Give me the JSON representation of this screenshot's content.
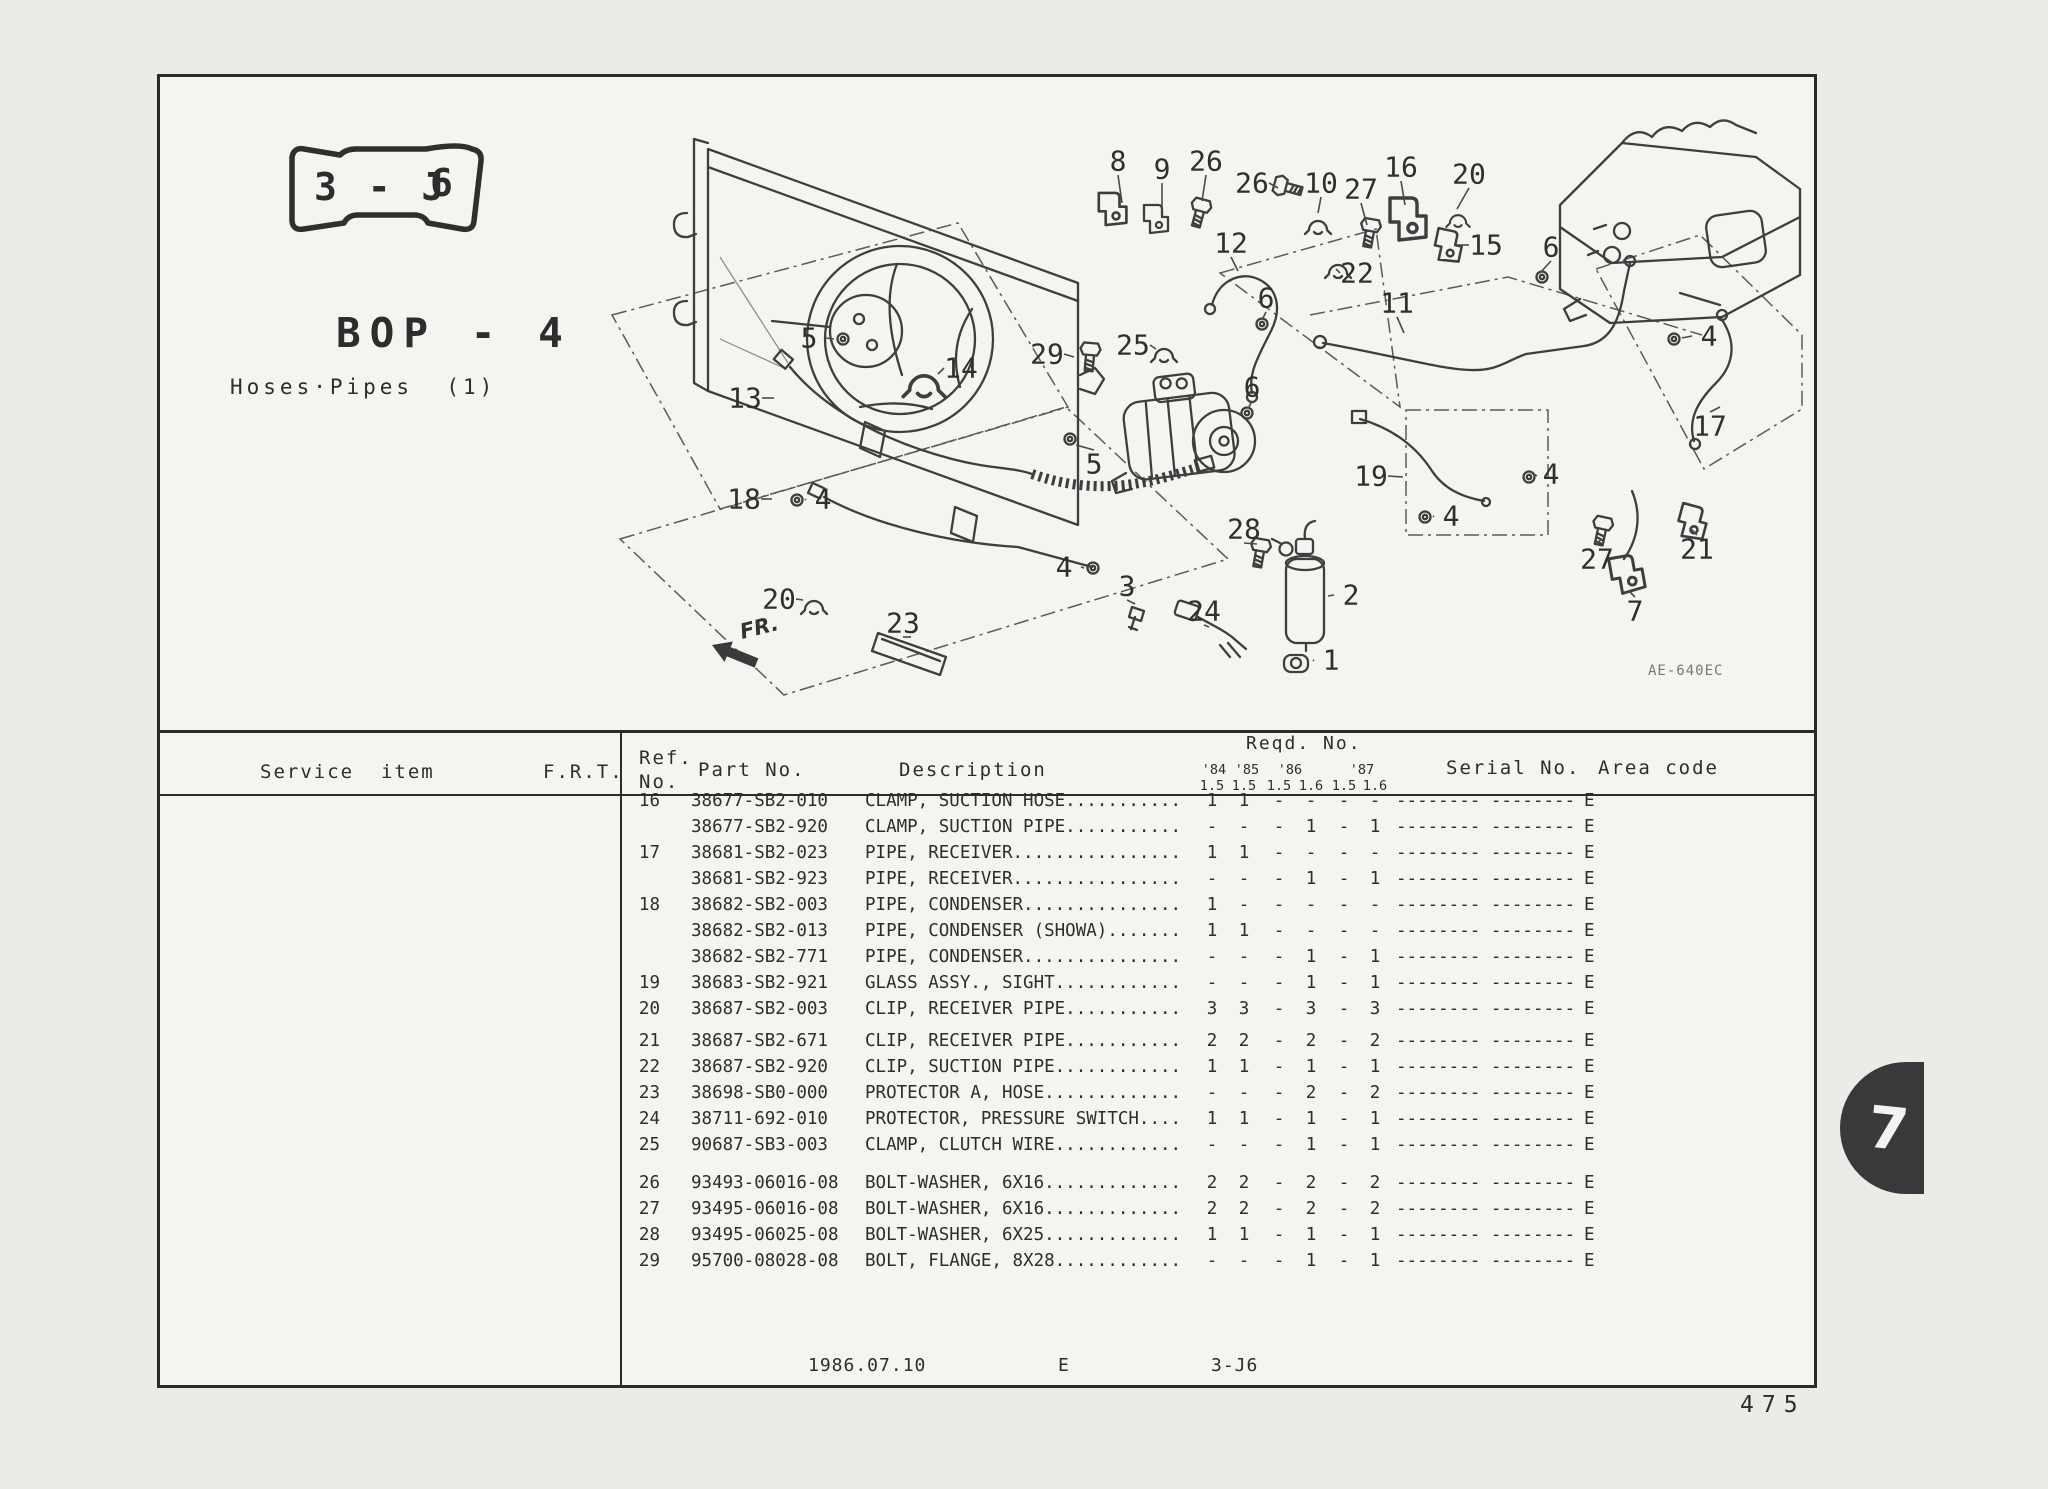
{
  "page": {
    "number": "475",
    "tab": "7"
  },
  "badge": {
    "left": "3 - J",
    "right": "6"
  },
  "header": {
    "title": "BOP - 4",
    "subtitle": "Hoses·Pipes  (1)"
  },
  "diagram": {
    "fr_label": "FR.",
    "code": "AE-640EC",
    "callouts": [
      {
        "t": "8",
        "x": 958,
        "y": 84,
        "lx": 962,
        "ly": 126
      },
      {
        "t": "9",
        "x": 1002,
        "y": 92,
        "lx": 1002,
        "ly": 134
      },
      {
        "t": "26",
        "x": 1046,
        "y": 84,
        "lx": 1042,
        "ly": 124
      },
      {
        "t": "26",
        "x": 1092,
        "y": 106,
        "lx": 1118,
        "ly": 111
      },
      {
        "t": "10",
        "x": 1161,
        "y": 106,
        "lx": 1158,
        "ly": 136
      },
      {
        "t": "27",
        "x": 1201,
        "y": 112,
        "lx": 1207,
        "ly": 148
      },
      {
        "t": "16",
        "x": 1241,
        "y": 90,
        "lx": 1245,
        "ly": 128
      },
      {
        "t": "20",
        "x": 1309,
        "y": 97,
        "lx": 1297,
        "ly": 132
      },
      {
        "t": "15",
        "x": 1326,
        "y": 168,
        "lx": 1298,
        "ly": 168
      },
      {
        "t": "12",
        "x": 1071,
        "y": 166,
        "lx": 1078,
        "ly": 194
      },
      {
        "t": "22",
        "x": 1197,
        "y": 196,
        "lx": 1176,
        "ly": 192
      },
      {
        "t": "6",
        "x": 1391,
        "y": 170,
        "lx": 1380,
        "ly": 196
      },
      {
        "t": "11",
        "x": 1237,
        "y": 226,
        "lx": 1244,
        "ly": 256
      },
      {
        "t": "29",
        "x": 887,
        "y": 277,
        "lx": 914,
        "ly": 280
      },
      {
        "t": "25",
        "x": 973,
        "y": 268,
        "lx": 996,
        "ly": 272
      },
      {
        "t": "6",
        "x": 1106,
        "y": 221,
        "lx": 1102,
        "ly": 243
      },
      {
        "t": "6",
        "x": 1092,
        "y": 310,
        "lx": 1088,
        "ly": 332
      },
      {
        "t": "5",
        "x": 649,
        "y": 261,
        "lx": 674,
        "ly": 262
      },
      {
        "t": "13",
        "x": 585,
        "y": 321,
        "lx": 614,
        "ly": 321
      },
      {
        "t": "14",
        "x": 801,
        "y": 291,
        "lx": 778,
        "ly": 297
      },
      {
        "t": "4",
        "x": 1549,
        "y": 259,
        "lx": 1522,
        "ly": 261
      },
      {
        "t": "17",
        "x": 1550,
        "y": 349,
        "lx": 1560,
        "ly": 330
      },
      {
        "t": "5",
        "x": 934,
        "y": 387,
        "lx": 916,
        "ly": 368
      },
      {
        "t": "19",
        "x": 1211,
        "y": 399,
        "lx": 1243,
        "ly": 400
      },
      {
        "t": "4",
        "x": 1391,
        "y": 397,
        "lx": 1377,
        "ly": 399
      },
      {
        "t": "18",
        "x": 584,
        "y": 422,
        "lx": 612,
        "ly": 422
      },
      {
        "t": "4",
        "x": 663,
        "y": 422,
        "lx": 645,
        "ly": 423
      },
      {
        "t": "4",
        "x": 1291,
        "y": 439,
        "lx": 1273,
        "ly": 440
      },
      {
        "t": "21",
        "x": 1537,
        "y": 472,
        "lx": 1531,
        "ly": 452
      },
      {
        "t": "28",
        "x": 1084,
        "y": 452,
        "lx": 1097,
        "ly": 467
      },
      {
        "t": "27",
        "x": 1437,
        "y": 482,
        "lx": 1441,
        "ly": 462
      },
      {
        "t": "4",
        "x": 904,
        "y": 490,
        "lx": 924,
        "ly": 491
      },
      {
        "t": "3",
        "x": 967,
        "y": 509,
        "lx": 975,
        "ly": 527
      },
      {
        "t": "2",
        "x": 1191,
        "y": 518,
        "lx": 1168,
        "ly": 519
      },
      {
        "t": "7",
        "x": 1475,
        "y": 534,
        "lx": 1469,
        "ly": 514
      },
      {
        "t": "20",
        "x": 619,
        "y": 522,
        "lx": 643,
        "ly": 523
      },
      {
        "t": "23",
        "x": 743,
        "y": 546,
        "lx": 751,
        "ly": 560
      },
      {
        "t": "24",
        "x": 1044,
        "y": 534,
        "lx": 1049,
        "ly": 550
      },
      {
        "t": "1",
        "x": 1171,
        "y": 583,
        "lx": 1153,
        "ly": 584
      }
    ]
  },
  "table": {
    "col_service": "Service  item",
    "col_frt": "F.R.T.",
    "col_ref": "Ref.",
    "col_ref2": "No.",
    "col_part": "Part No.",
    "col_desc": "Description",
    "col_reqd": "Reqd. No.",
    "years": [
      "'84",
      "'85",
      "'86",
      "'87"
    ],
    "sizes": [
      "1.5",
      "1.5",
      "1.5",
      "1.6",
      "1.5",
      "1.6"
    ],
    "col_serial": "Serial No.",
    "col_area": "Area code",
    "groups": [
      [
        {
          "ref": "16",
          "part": "38677-SB2-010",
          "desc": "CLAMP, SUCTION HOSE...........",
          "qty": [
            "1",
            "1",
            "-",
            "-",
            "-",
            "-"
          ],
          "serial": "-------- --------",
          "area": "E"
        },
        {
          "ref": "",
          "part": "38677-SB2-920",
          "desc": "CLAMP, SUCTION PIPE...........",
          "qty": [
            "-",
            "-",
            "-",
            "1",
            "-",
            "1"
          ],
          "serial": "-------- --------",
          "area": "E"
        },
        {
          "ref": "17",
          "part": "38681-SB2-023",
          "desc": "PIPE, RECEIVER................",
          "qty": [
            "1",
            "1",
            "-",
            "-",
            "-",
            "-"
          ],
          "serial": "-------- --------",
          "area": "E"
        },
        {
          "ref": "",
          "part": "38681-SB2-923",
          "desc": "PIPE, RECEIVER................",
          "qty": [
            "-",
            "-",
            "-",
            "1",
            "-",
            "1"
          ],
          "serial": "-------- --------",
          "area": "E"
        },
        {
          "ref": "18",
          "part": "38682-SB2-003",
          "desc": "PIPE, CONDENSER...............",
          "qty": [
            "1",
            "-",
            "-",
            "-",
            "-",
            "-"
          ],
          "serial": "-------- --------",
          "area": "E"
        },
        {
          "ref": "",
          "part": "38682-SB2-013",
          "desc": "PIPE, CONDENSER (SHOWA).......",
          "qty": [
            "1",
            "1",
            "-",
            "-",
            "-",
            "-"
          ],
          "serial": "-------- --------",
          "area": "E"
        },
        {
          "ref": "",
          "part": "38682-SB2-771",
          "desc": "PIPE, CONDENSER...............",
          "qty": [
            "-",
            "-",
            "-",
            "1",
            "-",
            "1"
          ],
          "serial": "-------- --------",
          "area": "E"
        },
        {
          "ref": "19",
          "part": "38683-SB2-921",
          "desc": "GLASS ASSY., SIGHT............",
          "qty": [
            "-",
            "-",
            "-",
            "1",
            "-",
            "1"
          ],
          "serial": "-------- --------",
          "area": "E"
        },
        {
          "ref": "20",
          "part": "38687-SB2-003",
          "desc": "CLIP, RECEIVER PIPE...........",
          "qty": [
            "3",
            "3",
            "-",
            "3",
            "-",
            "3"
          ],
          "serial": "-------- --------",
          "area": "E"
        }
      ],
      [
        {
          "ref": "21",
          "part": "38687-SB2-671",
          "desc": "CLIP, RECEIVER PIPE...........",
          "qty": [
            "2",
            "2",
            "-",
            "2",
            "-",
            "2"
          ],
          "serial": "-------- --------",
          "area": "E"
        },
        {
          "ref": "22",
          "part": "38687-SB2-920",
          "desc": "CLIP, SUCTION PIPE............",
          "qty": [
            "1",
            "1",
            "-",
            "1",
            "-",
            "1"
          ],
          "serial": "-------- --------",
          "area": "E"
        },
        {
          "ref": "23",
          "part": "38698-SB0-000",
          "desc": "PROTECTOR A, HOSE.............",
          "qty": [
            "-",
            "-",
            "-",
            "2",
            "-",
            "2"
          ],
          "serial": "-------- --------",
          "area": "E"
        },
        {
          "ref": "24",
          "part": "38711-692-010",
          "desc": "PROTECTOR, PRESSURE SWITCH....",
          "qty": [
            "1",
            "1",
            "-",
            "1",
            "-",
            "1"
          ],
          "serial": "-------- --------",
          "area": "E"
        },
        {
          "ref": "25",
          "part": "90687-SB3-003",
          "desc": "CLAMP, CLUTCH WIRE............",
          "qty": [
            "-",
            "-",
            "-",
            "1",
            "-",
            "1"
          ],
          "serial": "-------- --------",
          "area": "E"
        }
      ],
      [
        {
          "ref": "26",
          "part": "93493-06016-08",
          "desc": "BOLT-WASHER, 6X16.............",
          "qty": [
            "2",
            "2",
            "-",
            "2",
            "-",
            "2"
          ],
          "serial": "-------- --------",
          "area": "E"
        },
        {
          "ref": "27",
          "part": "93495-06016-08",
          "desc": "BOLT-WASHER, 6X16.............",
          "qty": [
            "2",
            "2",
            "-",
            "2",
            "-",
            "2"
          ],
          "serial": "-------- --------",
          "area": "E"
        },
        {
          "ref": "28",
          "part": "93495-06025-08",
          "desc": "BOLT-WASHER, 6X25.............",
          "qty": [
            "1",
            "1",
            "-",
            "1",
            "-",
            "1"
          ],
          "serial": "-------- --------",
          "area": "E"
        },
        {
          "ref": "29",
          "part": "95700-08028-08",
          "desc": "BOLT, FLANGE, 8X28............",
          "qty": [
            "-",
            "-",
            "-",
            "1",
            "-",
            "1"
          ],
          "serial": "-------- --------",
          "area": "E"
        }
      ]
    ]
  },
  "footer": {
    "date": "1986.07.10",
    "code": "E",
    "section": "3-J6"
  }
}
